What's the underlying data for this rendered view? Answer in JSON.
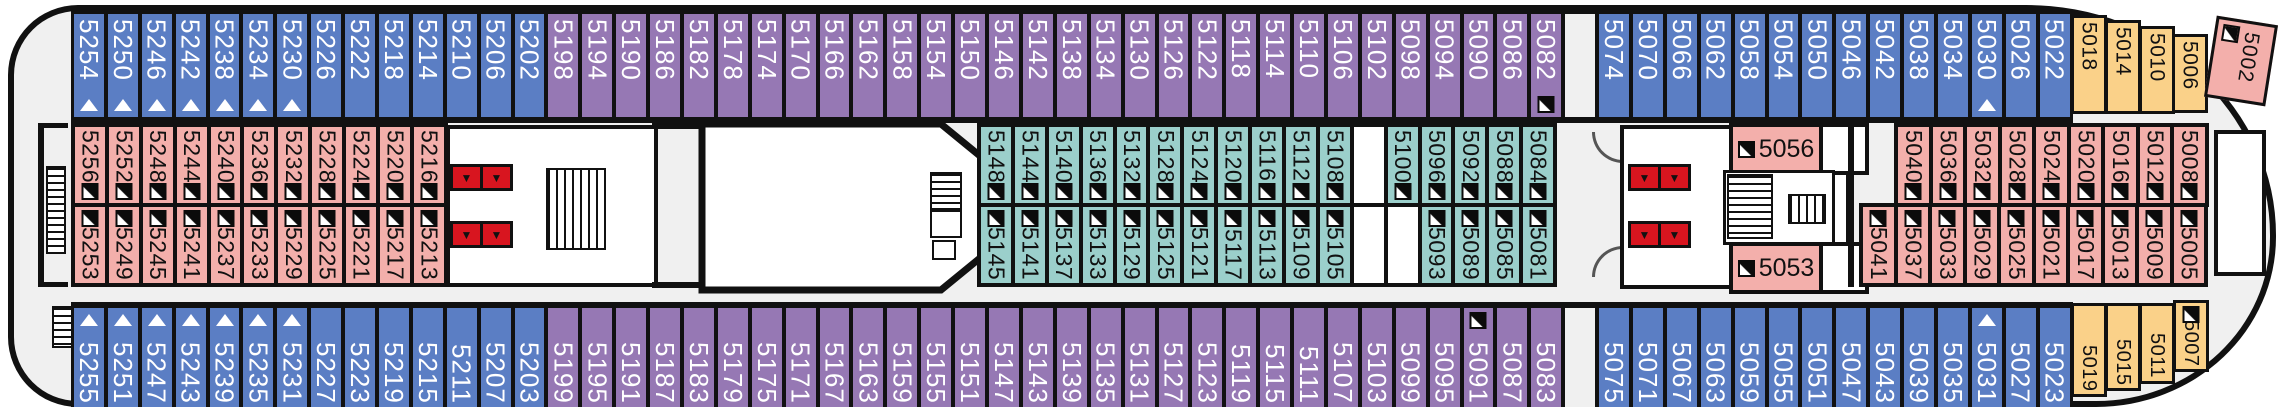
{
  "deck": {
    "colors": {
      "outer_port_starboard": "#5b7ec4",
      "outer_mid": "#9678b4",
      "inner_pink": "#f3afab",
      "inner_teal": "#9bcfcb",
      "bow_yellow": "#fad189",
      "elevator_red": "#d8151f",
      "hull_fill": "#f0f0f0",
      "outline": "#111111"
    },
    "icons": {
      "berth_triangle": "white-triangle-up",
      "sofa_bed_marker": "black-square-white-corner-triangle",
      "elevator": "red-box-down-triangle",
      "stairs": "striped-box",
      "door": "quarter-arc"
    },
    "rows": {
      "top": [
        {
          "n": "5254",
          "c": "blue",
          "t": 1
        },
        {
          "n": "5250",
          "c": "blue",
          "t": 1
        },
        {
          "n": "5246",
          "c": "blue",
          "t": 1
        },
        {
          "n": "5242",
          "c": "blue",
          "t": 1
        },
        {
          "n": "5238",
          "c": "blue",
          "t": 1
        },
        {
          "n": "5234",
          "c": "blue",
          "t": 1
        },
        {
          "n": "5230",
          "c": "blue",
          "t": 1
        },
        {
          "n": "5226",
          "c": "blue"
        },
        {
          "n": "5222",
          "c": "blue"
        },
        {
          "n": "5218",
          "c": "blue"
        },
        {
          "n": "5214",
          "c": "blue"
        },
        {
          "n": "5210",
          "c": "blue"
        },
        {
          "n": "5206",
          "c": "blue"
        },
        {
          "n": "5202",
          "c": "blue"
        },
        {
          "n": "5198",
          "c": "purple"
        },
        {
          "n": "5194",
          "c": "purple"
        },
        {
          "n": "5190",
          "c": "purple"
        },
        {
          "n": "5186",
          "c": "purple"
        },
        {
          "n": "5182",
          "c": "purple"
        },
        {
          "n": "5178",
          "c": "purple"
        },
        {
          "n": "5174",
          "c": "purple"
        },
        {
          "n": "5170",
          "c": "purple"
        },
        {
          "n": "5166",
          "c": "purple"
        },
        {
          "n": "5162",
          "c": "purple"
        },
        {
          "n": "5158",
          "c": "purple"
        },
        {
          "n": "5154",
          "c": "purple"
        },
        {
          "n": "5150",
          "c": "purple"
        },
        {
          "n": "5146",
          "c": "purple"
        },
        {
          "n": "5142",
          "c": "purple"
        },
        {
          "n": "5138",
          "c": "purple"
        },
        {
          "n": "5134",
          "c": "purple"
        },
        {
          "n": "5130",
          "c": "purple"
        },
        {
          "n": "5126",
          "c": "purple"
        },
        {
          "n": "5122",
          "c": "purple"
        },
        {
          "n": "5118",
          "c": "purple"
        },
        {
          "n": "5114",
          "c": "purple"
        },
        {
          "n": "5110",
          "c": "purple"
        },
        {
          "n": "5106",
          "c": "purple"
        },
        {
          "n": "5102",
          "c": "purple"
        },
        {
          "n": "5098",
          "c": "purple"
        },
        {
          "n": "5094",
          "c": "purple"
        },
        {
          "n": "5090",
          "c": "purple"
        },
        {
          "n": "5086",
          "c": "purple"
        },
        {
          "n": "5082",
          "c": "purple",
          "m": 1
        },
        {
          "gap": 1
        },
        {
          "n": "5074",
          "c": "blue"
        },
        {
          "n": "5070",
          "c": "blue"
        },
        {
          "n": "5066",
          "c": "blue"
        },
        {
          "n": "5062",
          "c": "blue"
        },
        {
          "n": "5058",
          "c": "blue"
        },
        {
          "n": "5054",
          "c": "blue"
        },
        {
          "n": "5050",
          "c": "blue"
        },
        {
          "n": "5046",
          "c": "blue"
        },
        {
          "n": "5042",
          "c": "blue"
        },
        {
          "n": "5038",
          "c": "blue"
        },
        {
          "n": "5034",
          "c": "blue"
        },
        {
          "n": "5030",
          "c": "blue",
          "t": 1
        },
        {
          "n": "5026",
          "c": "blue"
        },
        {
          "n": "5022",
          "c": "blue"
        }
      ],
      "top_yellow": [
        {
          "n": "5018",
          "c": "yellow"
        },
        {
          "n": "5014",
          "c": "yellow"
        },
        {
          "n": "5010",
          "c": "yellow"
        },
        {
          "n": "5006",
          "c": "yellow"
        }
      ],
      "bow_cabin": {
        "n": "5002",
        "m": 1
      },
      "mid_left_top": [
        {
          "n": "5256",
          "c": "pink",
          "m": 1
        },
        {
          "n": "5252",
          "c": "pink",
          "m": 1
        },
        {
          "n": "5248",
          "c": "pink",
          "m": 1
        },
        {
          "n": "5244",
          "c": "pink",
          "m": 1
        },
        {
          "n": "5240",
          "c": "pink",
          "m": 1
        },
        {
          "n": "5236",
          "c": "pink",
          "m": 1
        },
        {
          "n": "5232",
          "c": "pink",
          "m": 1
        },
        {
          "n": "5228",
          "c": "pink",
          "m": 1
        },
        {
          "n": "5224",
          "c": "pink",
          "m": 1
        },
        {
          "n": "5220",
          "c": "pink",
          "m": 1
        },
        {
          "n": "5216",
          "c": "pink",
          "m": 1
        }
      ],
      "mid_left_bottom": [
        {
          "n": "5253",
          "c": "pink",
          "m": 1
        },
        {
          "n": "5249",
          "c": "pink",
          "m": 1
        },
        {
          "n": "5245",
          "c": "pink",
          "m": 1
        },
        {
          "n": "5241",
          "c": "pink",
          "m": 1
        },
        {
          "n": "5237",
          "c": "pink",
          "m": 1
        },
        {
          "n": "5233",
          "c": "pink",
          "m": 1
        },
        {
          "n": "5229",
          "c": "pink",
          "m": 1
        },
        {
          "n": "5225",
          "c": "pink",
          "m": 1
        },
        {
          "n": "5221",
          "c": "pink",
          "m": 1
        },
        {
          "n": "5217",
          "c": "pink",
          "m": 1
        },
        {
          "n": "5213",
          "c": "pink",
          "m": 1
        }
      ],
      "mid_center_top": [
        {
          "n": "5148",
          "c": "teal",
          "m": 1
        },
        {
          "n": "5144",
          "c": "teal",
          "m": 1
        },
        {
          "n": "5140",
          "c": "teal",
          "m": 1
        },
        {
          "n": "5136",
          "c": "teal",
          "m": 1
        },
        {
          "n": "5132",
          "c": "teal",
          "m": 1
        },
        {
          "n": "5128",
          "c": "teal",
          "m": 1
        },
        {
          "n": "5124",
          "c": "teal",
          "m": 1
        },
        {
          "n": "5120",
          "c": "teal",
          "m": 1
        },
        {
          "n": "5116",
          "c": "teal",
          "m": 1
        },
        {
          "n": "5112",
          "c": "teal",
          "m": 1
        },
        {
          "n": "5108",
          "c": "teal",
          "m": 1
        },
        {
          "gap": 1
        },
        {
          "n": "5100",
          "c": "teal",
          "m": 1
        },
        {
          "n": "5096",
          "c": "teal",
          "m": 1
        },
        {
          "n": "5092",
          "c": "teal",
          "m": 1
        },
        {
          "n": "5088",
          "c": "teal",
          "m": 1
        },
        {
          "n": "5084",
          "c": "teal",
          "m": 1
        }
      ],
      "mid_center_bottom": [
        {
          "n": "5145",
          "c": "teal",
          "m": 1
        },
        {
          "n": "5141",
          "c": "teal",
          "m": 1
        },
        {
          "n": "5137",
          "c": "teal",
          "m": 1
        },
        {
          "n": "5133",
          "c": "teal",
          "m": 1
        },
        {
          "n": "5129",
          "c": "teal",
          "m": 1
        },
        {
          "n": "5125",
          "c": "teal",
          "m": 1
        },
        {
          "n": "5121",
          "c": "teal",
          "m": 1
        },
        {
          "n": "5117",
          "c": "teal",
          "m": 1
        },
        {
          "n": "5113",
          "c": "teal",
          "m": 1
        },
        {
          "n": "5109",
          "c": "teal",
          "m": 1
        },
        {
          "n": "5105",
          "c": "teal",
          "m": 1
        },
        {
          "gap": 1
        },
        {
          "gap": 1
        },
        {
          "n": "5093",
          "c": "teal",
          "m": 1
        },
        {
          "n": "5089",
          "c": "teal",
          "m": 1
        },
        {
          "n": "5085",
          "c": "teal",
          "m": 1
        },
        {
          "n": "5081",
          "c": "teal",
          "m": 1
        }
      ],
      "mid_right_top": [
        {
          "n": "5040",
          "c": "pink",
          "m": 1
        },
        {
          "n": "5036",
          "c": "pink",
          "m": 1
        },
        {
          "n": "5032",
          "c": "pink",
          "m": 1
        },
        {
          "n": "5028",
          "c": "pink",
          "m": 1
        },
        {
          "n": "5024",
          "c": "pink",
          "m": 1
        },
        {
          "n": "5020",
          "c": "pink",
          "m": 1
        },
        {
          "n": "5016",
          "c": "pink",
          "m": 1
        },
        {
          "n": "5012",
          "c": "pink",
          "m": 1
        },
        {
          "n": "5008",
          "c": "pink",
          "m": 1
        }
      ],
      "mid_right_bottom": [
        {
          "n": "5041",
          "c": "pink",
          "m": 1
        },
        {
          "n": "5037",
          "c": "pink",
          "m": 1
        },
        {
          "n": "5033",
          "c": "pink",
          "m": 1
        },
        {
          "n": "5029",
          "c": "pink",
          "m": 1
        },
        {
          "n": "5025",
          "c": "pink",
          "m": 1
        },
        {
          "n": "5021",
          "c": "pink",
          "m": 1
        },
        {
          "n": "5017",
          "c": "pink",
          "m": 1
        },
        {
          "n": "5013",
          "c": "pink",
          "m": 1
        },
        {
          "n": "5009",
          "c": "pink",
          "m": 1
        },
        {
          "n": "5005",
          "c": "pink",
          "m": 1
        }
      ],
      "cabin_5056": {
        "n": "5056",
        "m": 1
      },
      "cabin_5053": {
        "n": "5053",
        "m": 1
      },
      "bottom": [
        {
          "n": "5255",
          "c": "blue",
          "t": 1
        },
        {
          "n": "5251",
          "c": "blue",
          "t": 1
        },
        {
          "n": "5247",
          "c": "blue",
          "t": 1
        },
        {
          "n": "5243",
          "c": "blue",
          "t": 1
        },
        {
          "n": "5239",
          "c": "blue",
          "t": 1
        },
        {
          "n": "5235",
          "c": "blue",
          "t": 1
        },
        {
          "n": "5231",
          "c": "blue",
          "t": 1
        },
        {
          "n": "5227",
          "c": "blue"
        },
        {
          "n": "5223",
          "c": "blue"
        },
        {
          "n": "5219",
          "c": "blue"
        },
        {
          "n": "5215",
          "c": "blue"
        },
        {
          "n": "5211",
          "c": "blue"
        },
        {
          "n": "5207",
          "c": "blue"
        },
        {
          "n": "5203",
          "c": "blue"
        },
        {
          "n": "5199",
          "c": "purple"
        },
        {
          "n": "5195",
          "c": "purple"
        },
        {
          "n": "5191",
          "c": "purple"
        },
        {
          "n": "5187",
          "c": "purple"
        },
        {
          "n": "5183",
          "c": "purple"
        },
        {
          "n": "5179",
          "c": "purple"
        },
        {
          "n": "5175",
          "c": "purple"
        },
        {
          "n": "5171",
          "c": "purple"
        },
        {
          "n": "5167",
          "c": "purple"
        },
        {
          "n": "5163",
          "c": "purple"
        },
        {
          "n": "5159",
          "c": "purple"
        },
        {
          "n": "5155",
          "c": "purple"
        },
        {
          "n": "5151",
          "c": "purple"
        },
        {
          "n": "5147",
          "c": "purple"
        },
        {
          "n": "5143",
          "c": "purple"
        },
        {
          "n": "5139",
          "c": "purple"
        },
        {
          "n": "5135",
          "c": "purple"
        },
        {
          "n": "5131",
          "c": "purple"
        },
        {
          "n": "5127",
          "c": "purple"
        },
        {
          "n": "5123",
          "c": "purple"
        },
        {
          "n": "5119",
          "c": "purple"
        },
        {
          "n": "5115",
          "c": "purple"
        },
        {
          "n": "5111",
          "c": "purple"
        },
        {
          "n": "5107",
          "c": "purple"
        },
        {
          "n": "5103",
          "c": "purple"
        },
        {
          "n": "5099",
          "c": "purple"
        },
        {
          "n": "5095",
          "c": "purple"
        },
        {
          "n": "5091",
          "c": "purple",
          "m": 1
        },
        {
          "n": "5087",
          "c": "purple"
        },
        {
          "n": "5083",
          "c": "purple"
        },
        {
          "gap": 1
        },
        {
          "n": "5075",
          "c": "blue"
        },
        {
          "n": "5071",
          "c": "blue"
        },
        {
          "n": "5067",
          "c": "blue"
        },
        {
          "n": "5063",
          "c": "blue"
        },
        {
          "n": "5059",
          "c": "blue"
        },
        {
          "n": "5055",
          "c": "blue"
        },
        {
          "n": "5051",
          "c": "blue"
        },
        {
          "n": "5047",
          "c": "blue"
        },
        {
          "n": "5043",
          "c": "blue"
        },
        {
          "n": "5039",
          "c": "blue"
        },
        {
          "n": "5035",
          "c": "blue"
        },
        {
          "n": "5031",
          "c": "blue",
          "t": 1
        },
        {
          "n": "5027",
          "c": "blue"
        },
        {
          "n": "5023",
          "c": "blue"
        }
      ],
      "bottom_yellow": [
        {
          "n": "5019",
          "c": "yellow"
        },
        {
          "n": "5015",
          "c": "yellow"
        },
        {
          "n": "5011",
          "c": "yellow"
        },
        {
          "n": "5007",
          "c": "yellow",
          "m": 1
        }
      ]
    }
  }
}
